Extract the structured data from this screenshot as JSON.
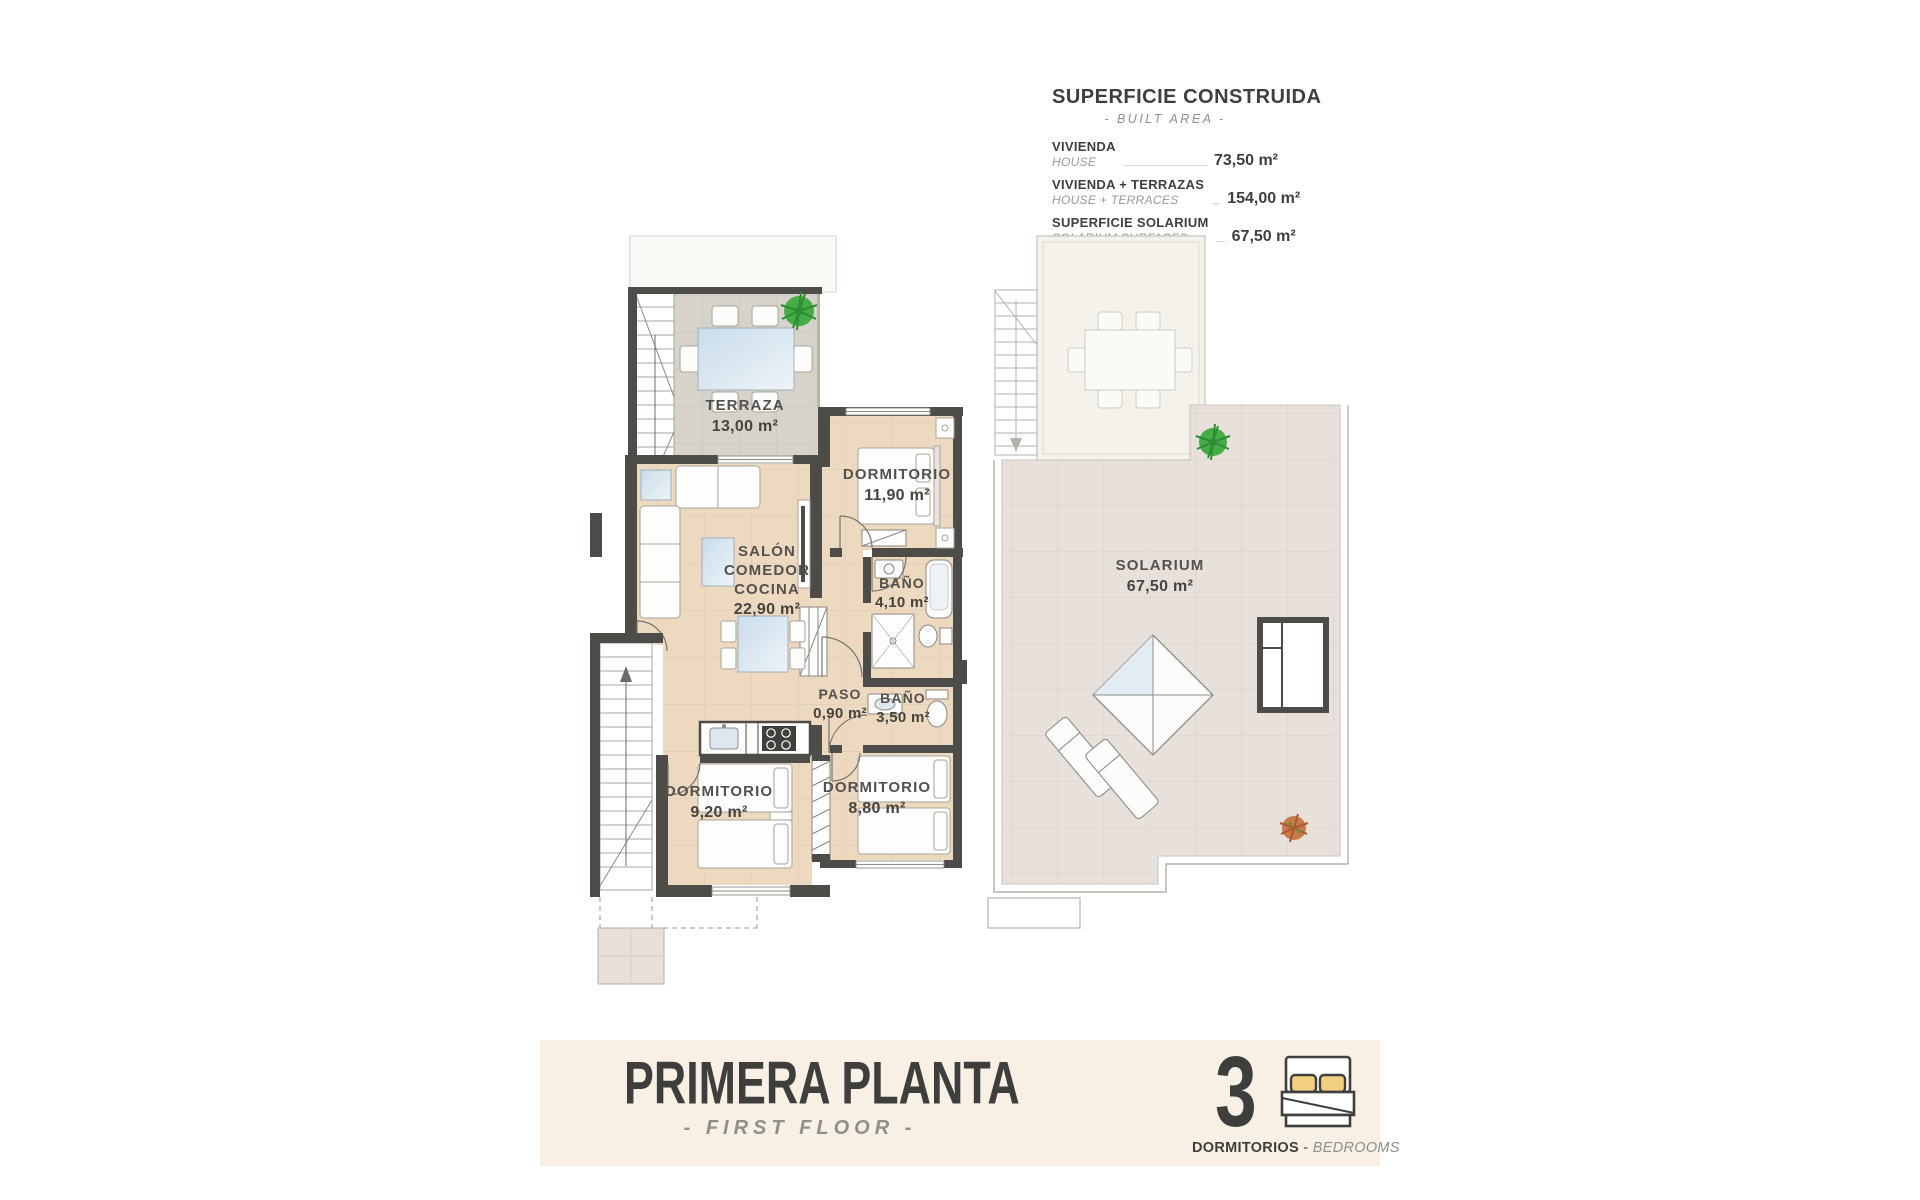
{
  "area_table": {
    "title": "SUPERFICIE CONSTRUIDA",
    "subtitle": "- BUILT AREA -",
    "rows": [
      {
        "label_es": "VIVIENDA",
        "label_en": "HOUSE",
        "value": "73,50 m²"
      },
      {
        "label_es": "VIVIENDA + TERRAZAS",
        "label_en": "HOUSE + TERRACES",
        "value": "154,00 m²"
      },
      {
        "label_es": "SUPERFICIE SOLARIUM",
        "label_en": "SOLARIUM SURFACES",
        "value": "67,50 m²"
      }
    ]
  },
  "rooms": {
    "terraza": {
      "name": "TERRAZA",
      "area": "13,00 m²"
    },
    "dormitorio_principal": {
      "name": "DORMITORIO",
      "area": "11,90 m²"
    },
    "salon": {
      "name": "SALÓN\nCOMEDOR\nCOCINA",
      "area": "22,90 m²"
    },
    "bano_1": {
      "name": "BAÑO",
      "area": "4,10 m²"
    },
    "paso": {
      "name": "PASO",
      "area": "0,90 m²"
    },
    "bano_2": {
      "name": "BAÑO",
      "area": "3,50 m²"
    },
    "dormitorio_2": {
      "name": "DORMITORIO",
      "area": "9,20 m²"
    },
    "dormitorio_3": {
      "name": "DORMITORIO",
      "area": "8,80 m²"
    },
    "solarium": {
      "name": "SOLARIUM",
      "area": "67,50 m²"
    }
  },
  "footer": {
    "title": "PRIMERA PLANTA",
    "subtitle": "- FIRST FLOOR -",
    "bedrooms_count": "3",
    "bedrooms_label_es": "DORMITORIOS",
    "separator": "-",
    "bedrooms_label_en": "BEDROOMS"
  },
  "icons": {
    "bedrooms": "double-bed-icon",
    "terrace_plant": "green-plant-icon",
    "solarium_plants": [
      "green-plant-icon",
      "orange-plant-icon"
    ]
  },
  "colors": {
    "wall": "#4d4c48",
    "floor_tile": "#ecd9c0",
    "terrace_tile": "#d8d3ca",
    "solarium_tile": "#e8e0da",
    "banner_bg": "#f8f0e4",
    "text_dark": "#3e3e3c",
    "text_gray": "#8f8f8c",
    "pillow_yellow": "#f2cf7f",
    "plant_green": "#45ad47",
    "glass_blue": "#cfe0ed"
  }
}
